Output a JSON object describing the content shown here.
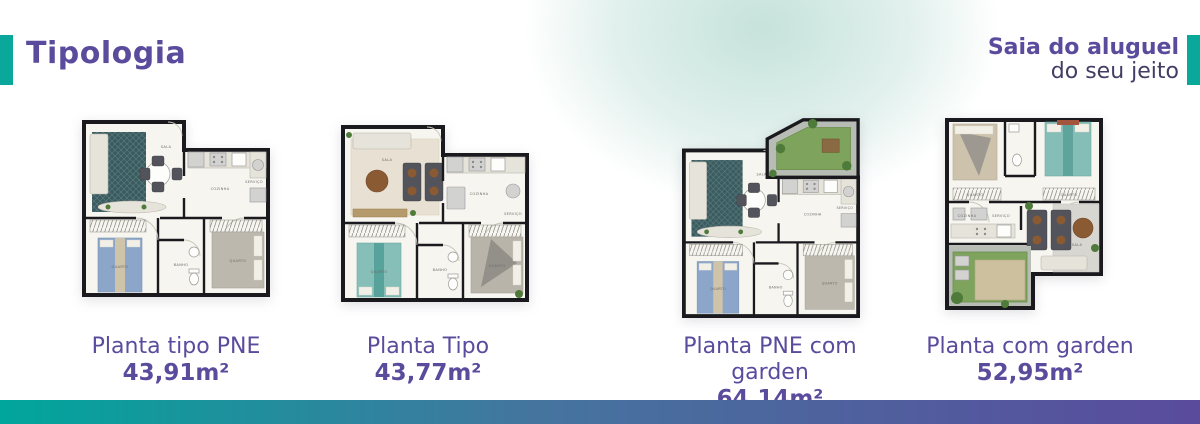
{
  "header": {
    "title": "Tipologia",
    "tagline_bold": "Saia do aluguel",
    "tagline_light": "do seu jeito"
  },
  "plans": [
    {
      "name": "Planta tipo PNE",
      "area": "43,91m²",
      "rooms": {
        "living": "SALA",
        "kitchen": "COZINHA",
        "service": "SERVIÇO",
        "bedroom1": "QUARTO",
        "bath": "BANHO",
        "bedroom2": "QUARTO"
      }
    },
    {
      "name": "Planta Tipo",
      "area": "43,77m²",
      "rooms": {
        "living": "SALA",
        "kitchen": "COZINHA",
        "service": "SERVIÇO",
        "bedroom1": "QUARTO",
        "bath": "BANHO",
        "bedroom2": "QUARTO"
      }
    },
    {
      "name": "Planta PNE com garden",
      "area": "64,14m²",
      "rooms": {
        "living": "SALA",
        "kitchen": "COZINHA",
        "service": "SERVIÇO",
        "bedroom1": "QUARTO",
        "bath": "BANHO",
        "bedroom2": "QUARTO"
      }
    },
    {
      "name": "Planta com garden",
      "area": "52,95m²",
      "rooms": {
        "bedroom1": "QUARTO",
        "bedroom2": "QUARTO",
        "kitchen": "COZINHA",
        "service": "SERVIÇO",
        "living": "SALA"
      }
    }
  ],
  "colors": {
    "accent_teal": "#0aa79b",
    "brand_purple": "#5a4b9d",
    "tagline_dark": "#443d63",
    "bar_gradient_left": "#00a69b",
    "bar_gradient_right": "#5a4b9d"
  }
}
